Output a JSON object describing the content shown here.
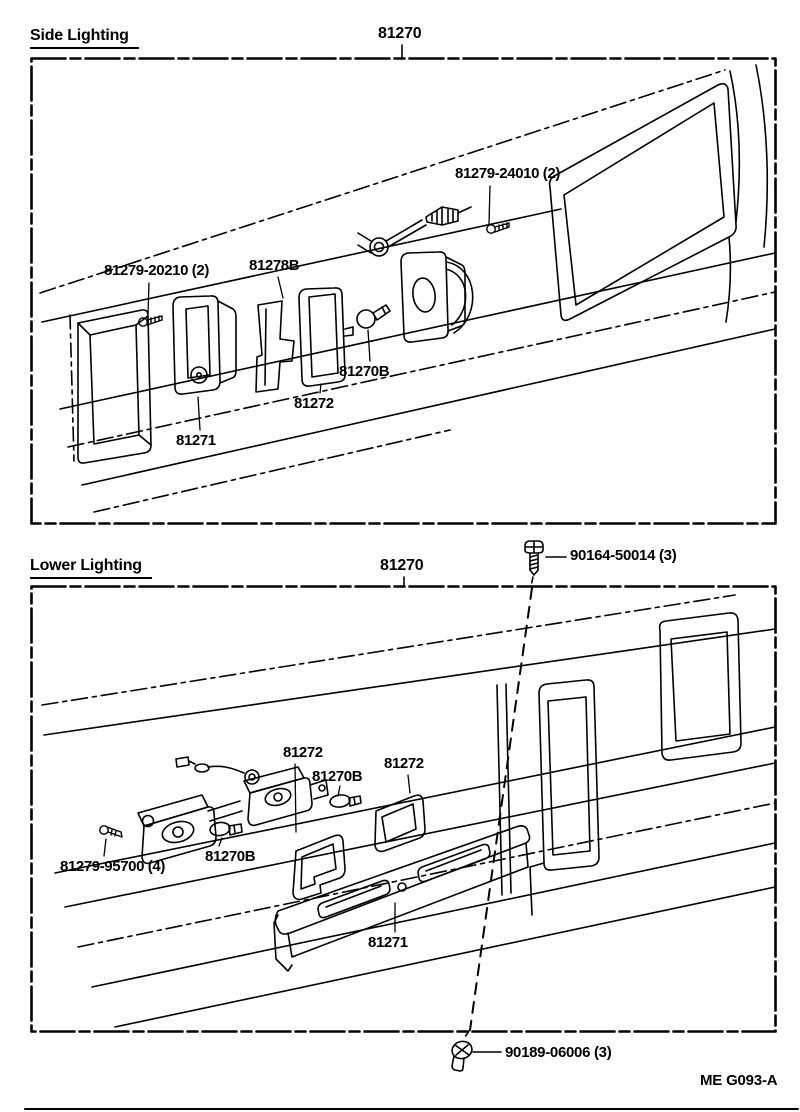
{
  "page": {
    "footer_code": "ME G093-A",
    "ink_color": "#000000",
    "paper_color": "#ffffff"
  },
  "fasteners": {
    "top_screw": {
      "label": "90164-50014 (3)",
      "icon": "screw-icon"
    },
    "bottom_screw": {
      "label": "90189-06006 (3)",
      "icon": "grommet-screw-icon"
    }
  },
  "sections": [
    {
      "title": "Side Lighting",
      "assembly_label": "81270",
      "parts": [
        {
          "text": "81279-24010 (2)"
        },
        {
          "text": "81279-20210 (2)"
        },
        {
          "text": "81278B"
        },
        {
          "text": "81270B"
        },
        {
          "text": "81272"
        },
        {
          "text": "81271"
        }
      ]
    },
    {
      "title": "Lower Lighting",
      "assembly_label": "81270",
      "parts": [
        {
          "text": "81272"
        },
        {
          "text": "81270B"
        },
        {
          "text": "81272"
        },
        {
          "text": "81279-95700 (4)"
        },
        {
          "text": "81270B"
        },
        {
          "text": "81271"
        }
      ]
    }
  ]
}
